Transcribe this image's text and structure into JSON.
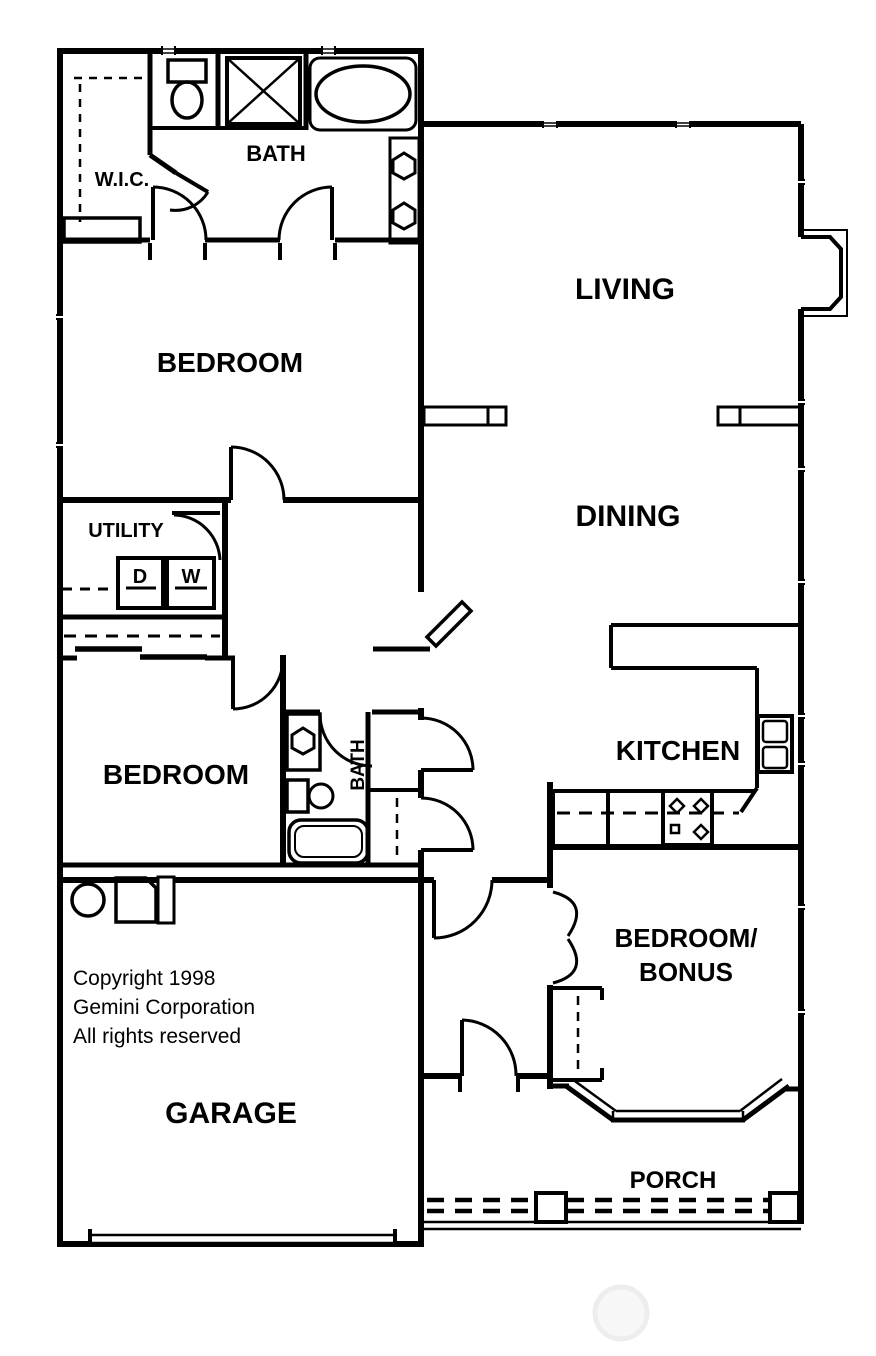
{
  "plan": {
    "title": "House floor plan",
    "colors": {
      "line": "#000000",
      "background": "#ffffff",
      "watermark": "#f0f0f0"
    },
    "rooms": {
      "wic": {
        "label": "W.I.C."
      },
      "bath_master": {
        "label": "BATH"
      },
      "bedroom_master": {
        "label": "BEDROOM"
      },
      "living": {
        "label": "LIVING"
      },
      "dining": {
        "label": "DINING"
      },
      "utility": {
        "label": "UTILITY"
      },
      "bedroom_second": {
        "label": "BEDROOM"
      },
      "bath_second": {
        "label": "BATH"
      },
      "kitchen": {
        "label": "KITCHEN"
      },
      "bonus": {
        "line1": "BEDROOM/",
        "line2": "BONUS"
      },
      "garage": {
        "label": "GARAGE"
      },
      "porch": {
        "label": "PORCH"
      }
    },
    "appliances": {
      "dryer": "D",
      "washer": "W"
    },
    "copyright": {
      "line1": "Copyright 1998",
      "line2": "Gemini Corporation",
      "line3": "All rights reserved"
    },
    "fixtures": [
      "toilet",
      "shower",
      "bathtub",
      "double-vanity-sinks",
      "dryer",
      "washer",
      "kitchen-sink",
      "range-cooktop",
      "refrigerator-space",
      "water-heater",
      "closet-rods",
      "bay-window",
      "porch-railing",
      "fireplace",
      "garage-door",
      "door-swings"
    ]
  }
}
